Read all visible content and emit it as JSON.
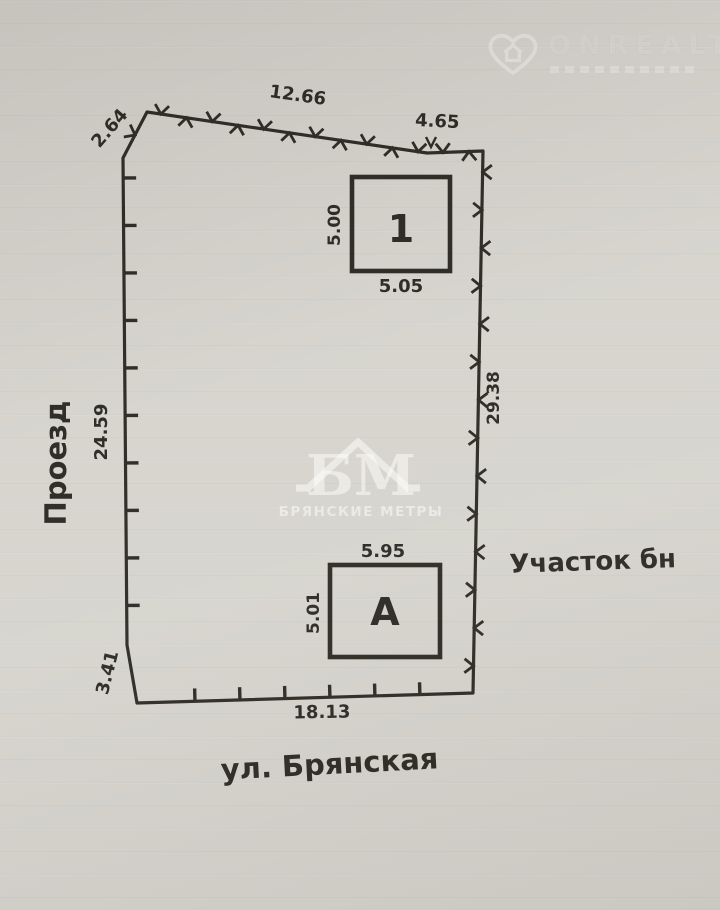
{
  "watermarks": {
    "onrealt": {
      "brand": "ONREALT"
    },
    "bm": {
      "monogram": "БМ",
      "name": "БРЯНСКИЕ МЕТРЫ"
    }
  },
  "plan": {
    "labels": {
      "driveway": "Проезд",
      "street": "ул. Брянская",
      "parcel": "Участок бн"
    },
    "dimensions": {
      "top_left_diagonal": "2.64",
      "top_main": "12.66",
      "top_right": "4.65",
      "left_main": "24.59",
      "left_bottom": "3.41",
      "right_main": "29.38",
      "bottom_main": "18.13"
    },
    "buildings": [
      {
        "label": "1",
        "left_dim": "5.00",
        "bottom_dim": "5.05"
      },
      {
        "label": "А",
        "left_dim": "5.01",
        "top_dim": "5.95"
      }
    ]
  },
  "colors": {
    "ink": "#29261f",
    "paper": "#d5d3cc"
  }
}
